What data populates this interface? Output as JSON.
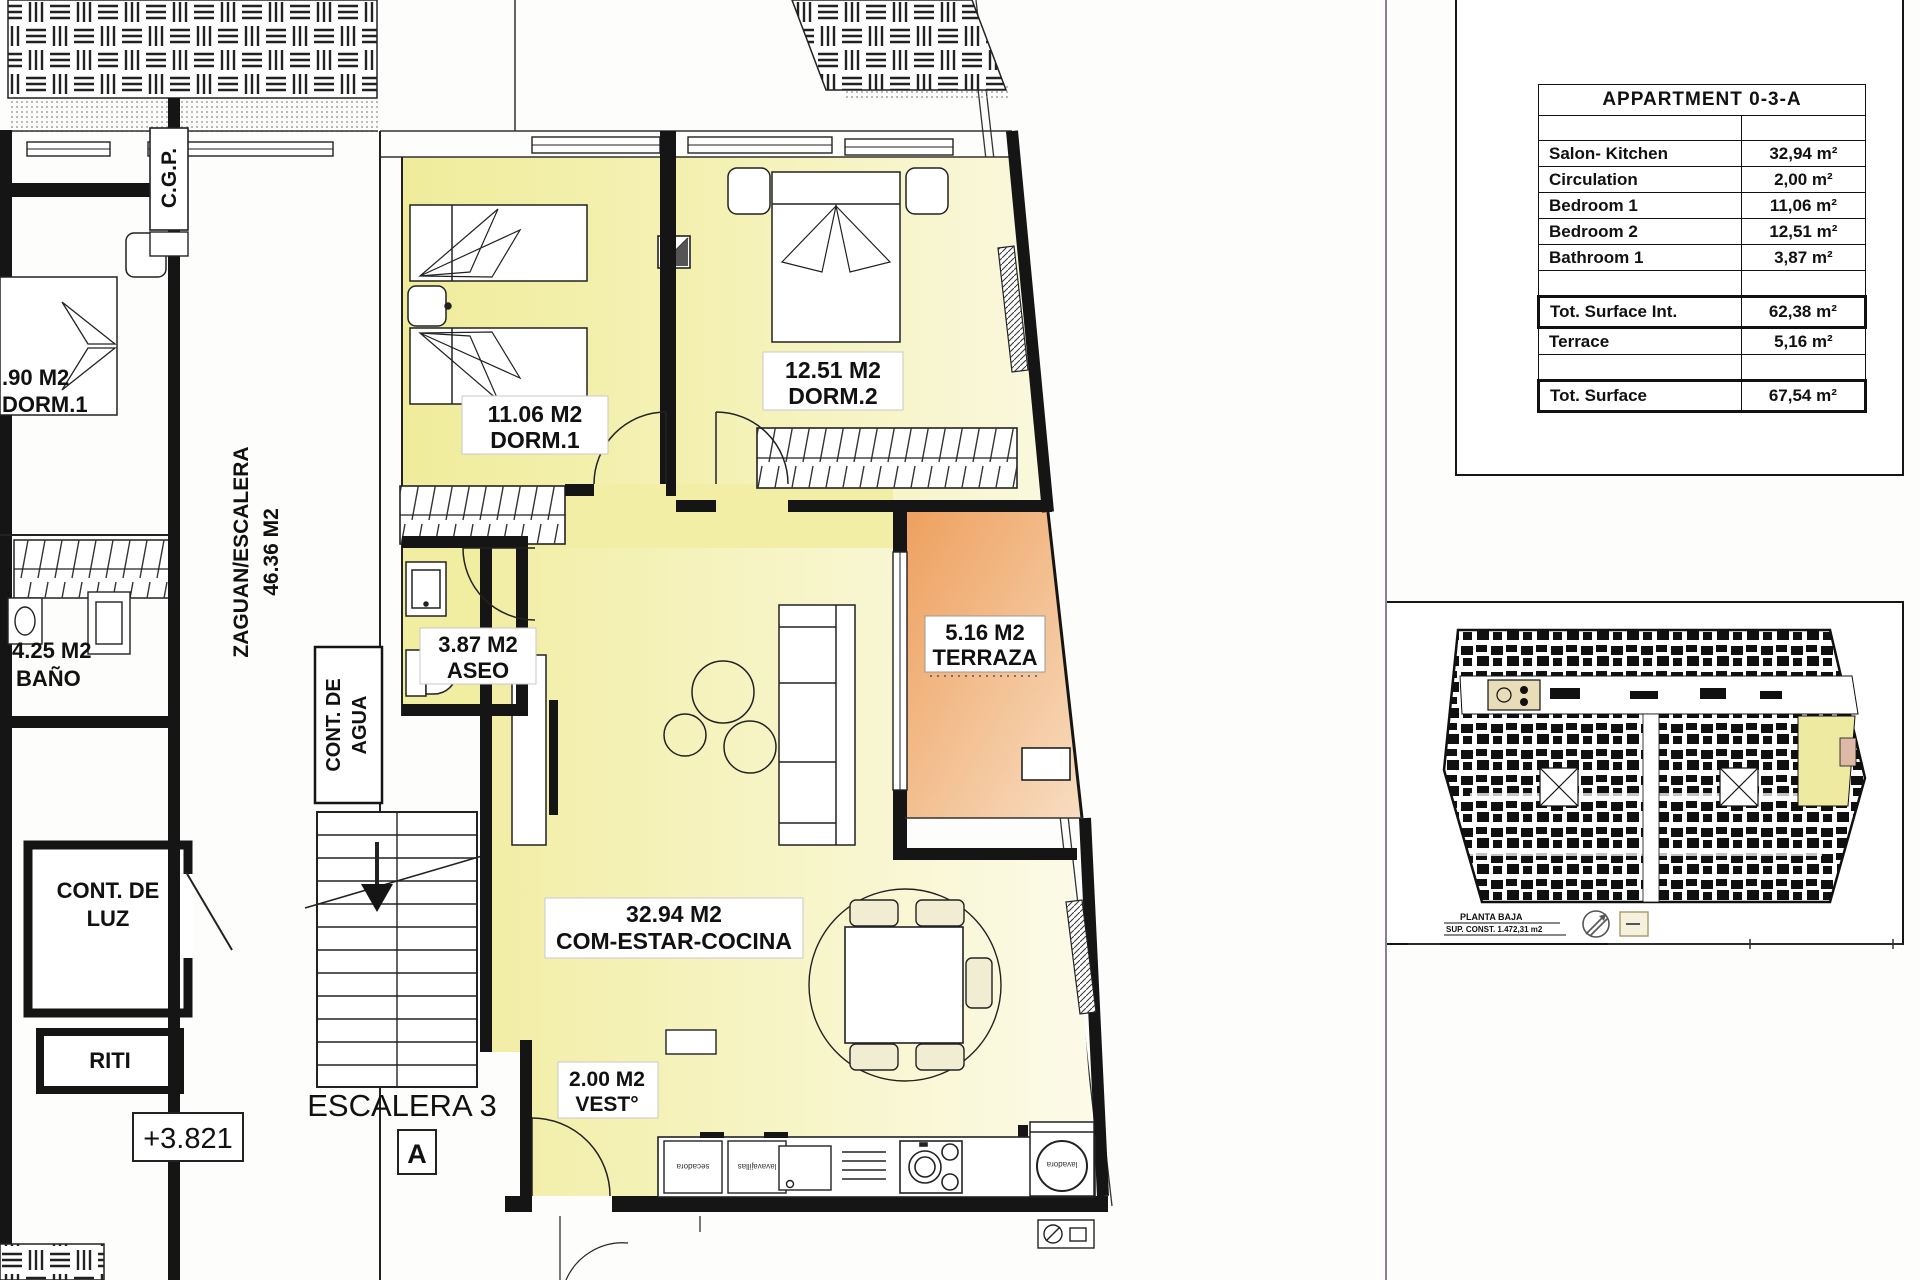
{
  "table": {
    "title": "APPARTMENT 0-3-A",
    "rows": [
      {
        "label": "Salon- Kitchen",
        "value": "32,94 m²"
      },
      {
        "label": "Circulation",
        "value": "2,00 m²"
      },
      {
        "label": "Bedroom 1",
        "value": "11,06 m²"
      },
      {
        "label": "Bedroom 2",
        "value": "12,51 m²"
      },
      {
        "label": "Bathroom 1",
        "value": "3,87 m²"
      }
    ],
    "tot_int": {
      "label": "Tot. Surface Int.",
      "value": "62,38 m²"
    },
    "terrace": {
      "label": "Terrace",
      "value": "5,16 m²"
    },
    "tot": {
      "label": "Tot. Surface",
      "value": "67,54 m²"
    }
  },
  "plan": {
    "labels": {
      "cgp": "C.G.P.",
      "zaguan_line1": "ZAGUAN/ESCALERA",
      "zaguan_line2": "46.36 M2",
      "left_dorm_area": ".90 M2",
      "left_dorm_name": "DORM.1",
      "bano_area": "4.25 M2",
      "bano_name": "BAÑO",
      "cont_agua_line1": "CONT. DE",
      "cont_agua_line2": "AGUA",
      "cont_luz_line1": "CONT. DE",
      "cont_luz_line2": "LUZ",
      "riti": "RITI",
      "escalera": "ESCALERA 3",
      "section_a": "A",
      "level": "+3.821",
      "dorm1_area": "11.06 M2",
      "dorm1_name": "DORM.1",
      "dorm2_area": "12.51 M2",
      "dorm2_name": "DORM.2",
      "aseo_area": "3.87 M2",
      "aseo_name": "ASEO",
      "terraza_area": "5.16 M2",
      "terraza_name": "TERRAZA",
      "living_area": "32.94 M2",
      "living_name": "COM-ESTAR-COCINA",
      "vest_area": "2.00 M2",
      "vest_name": "VEST°",
      "appliance1": "secadora",
      "appliance2": "lavavajillas",
      "appliance3": "lavadora"
    },
    "colors": {
      "room_yellow": "#f1eda1",
      "room_yellow_light": "#faf8dd",
      "terrace_orange": "#eea05e",
      "terrace_orange_light": "#f8ddc1",
      "wall_black": "#151515",
      "separator_purple": "#8d7f91",
      "chair_beige": "#f0edd2"
    }
  },
  "mini": {
    "caption_line1": "PLANTA BAJA",
    "caption_line2": "SUP. CONST. 1.472,31 m2"
  }
}
